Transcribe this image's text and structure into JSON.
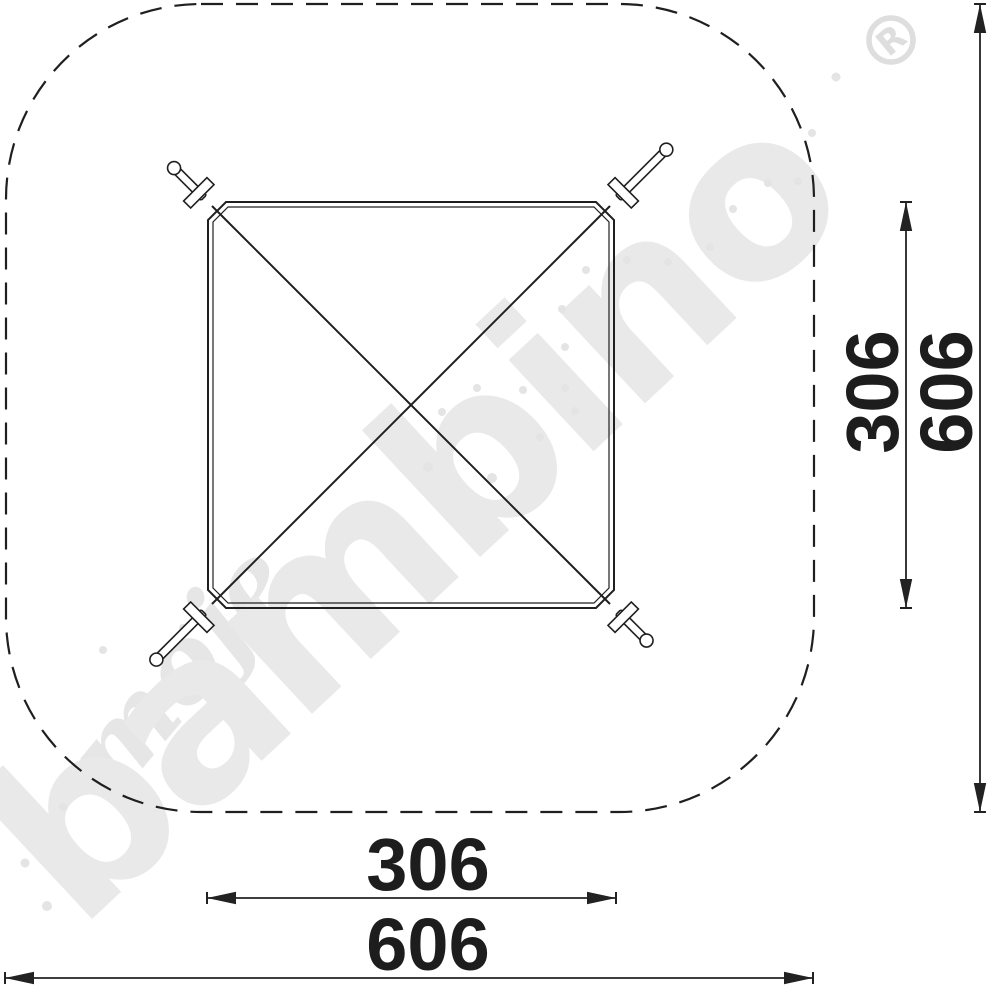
{
  "drawing": {
    "description": "Top view technical drawing of square playground equipment with safety zone",
    "line_color": "#1f1f1f",
    "dimensions": {
      "bottom_inner": {
        "value": "306"
      },
      "bottom_outer": {
        "value": "606"
      },
      "right_inner": {
        "value": "306"
      },
      "right_outer": {
        "value": "606"
      }
    },
    "watermark": {
      "script_text": "moje",
      "brand_text": "bambino",
      "registered_symbol": "R",
      "color": "#e8e8e8",
      "dots": [
        [
          836,
          77,
          4.5
        ],
        [
          812,
          133,
          4
        ],
        [
          798,
          181,
          4
        ],
        [
          768,
          183,
          4
        ],
        [
          733,
          209,
          4
        ],
        [
          710,
          247,
          4
        ],
        [
          668,
          262,
          4
        ],
        [
          627,
          260,
          4
        ],
        [
          586,
          270,
          4
        ],
        [
          562,
          309,
          4
        ],
        [
          565,
          347,
          4
        ],
        [
          523,
          390,
          4
        ],
        [
          565,
          388,
          4
        ],
        [
          575,
          411,
          4
        ],
        [
          477,
          388,
          4
        ],
        [
          442,
          412,
          4
        ],
        [
          428,
          467,
          5
        ],
        [
          492,
          478,
          5
        ],
        [
          540,
          437,
          4
        ],
        [
          25,
          863,
          4.5
        ],
        [
          47,
          906,
          5
        ],
        [
          63,
          807,
          4
        ],
        [
          103,
          650,
          4
        ],
        [
          183,
          628,
          4
        ]
      ]
    }
  }
}
